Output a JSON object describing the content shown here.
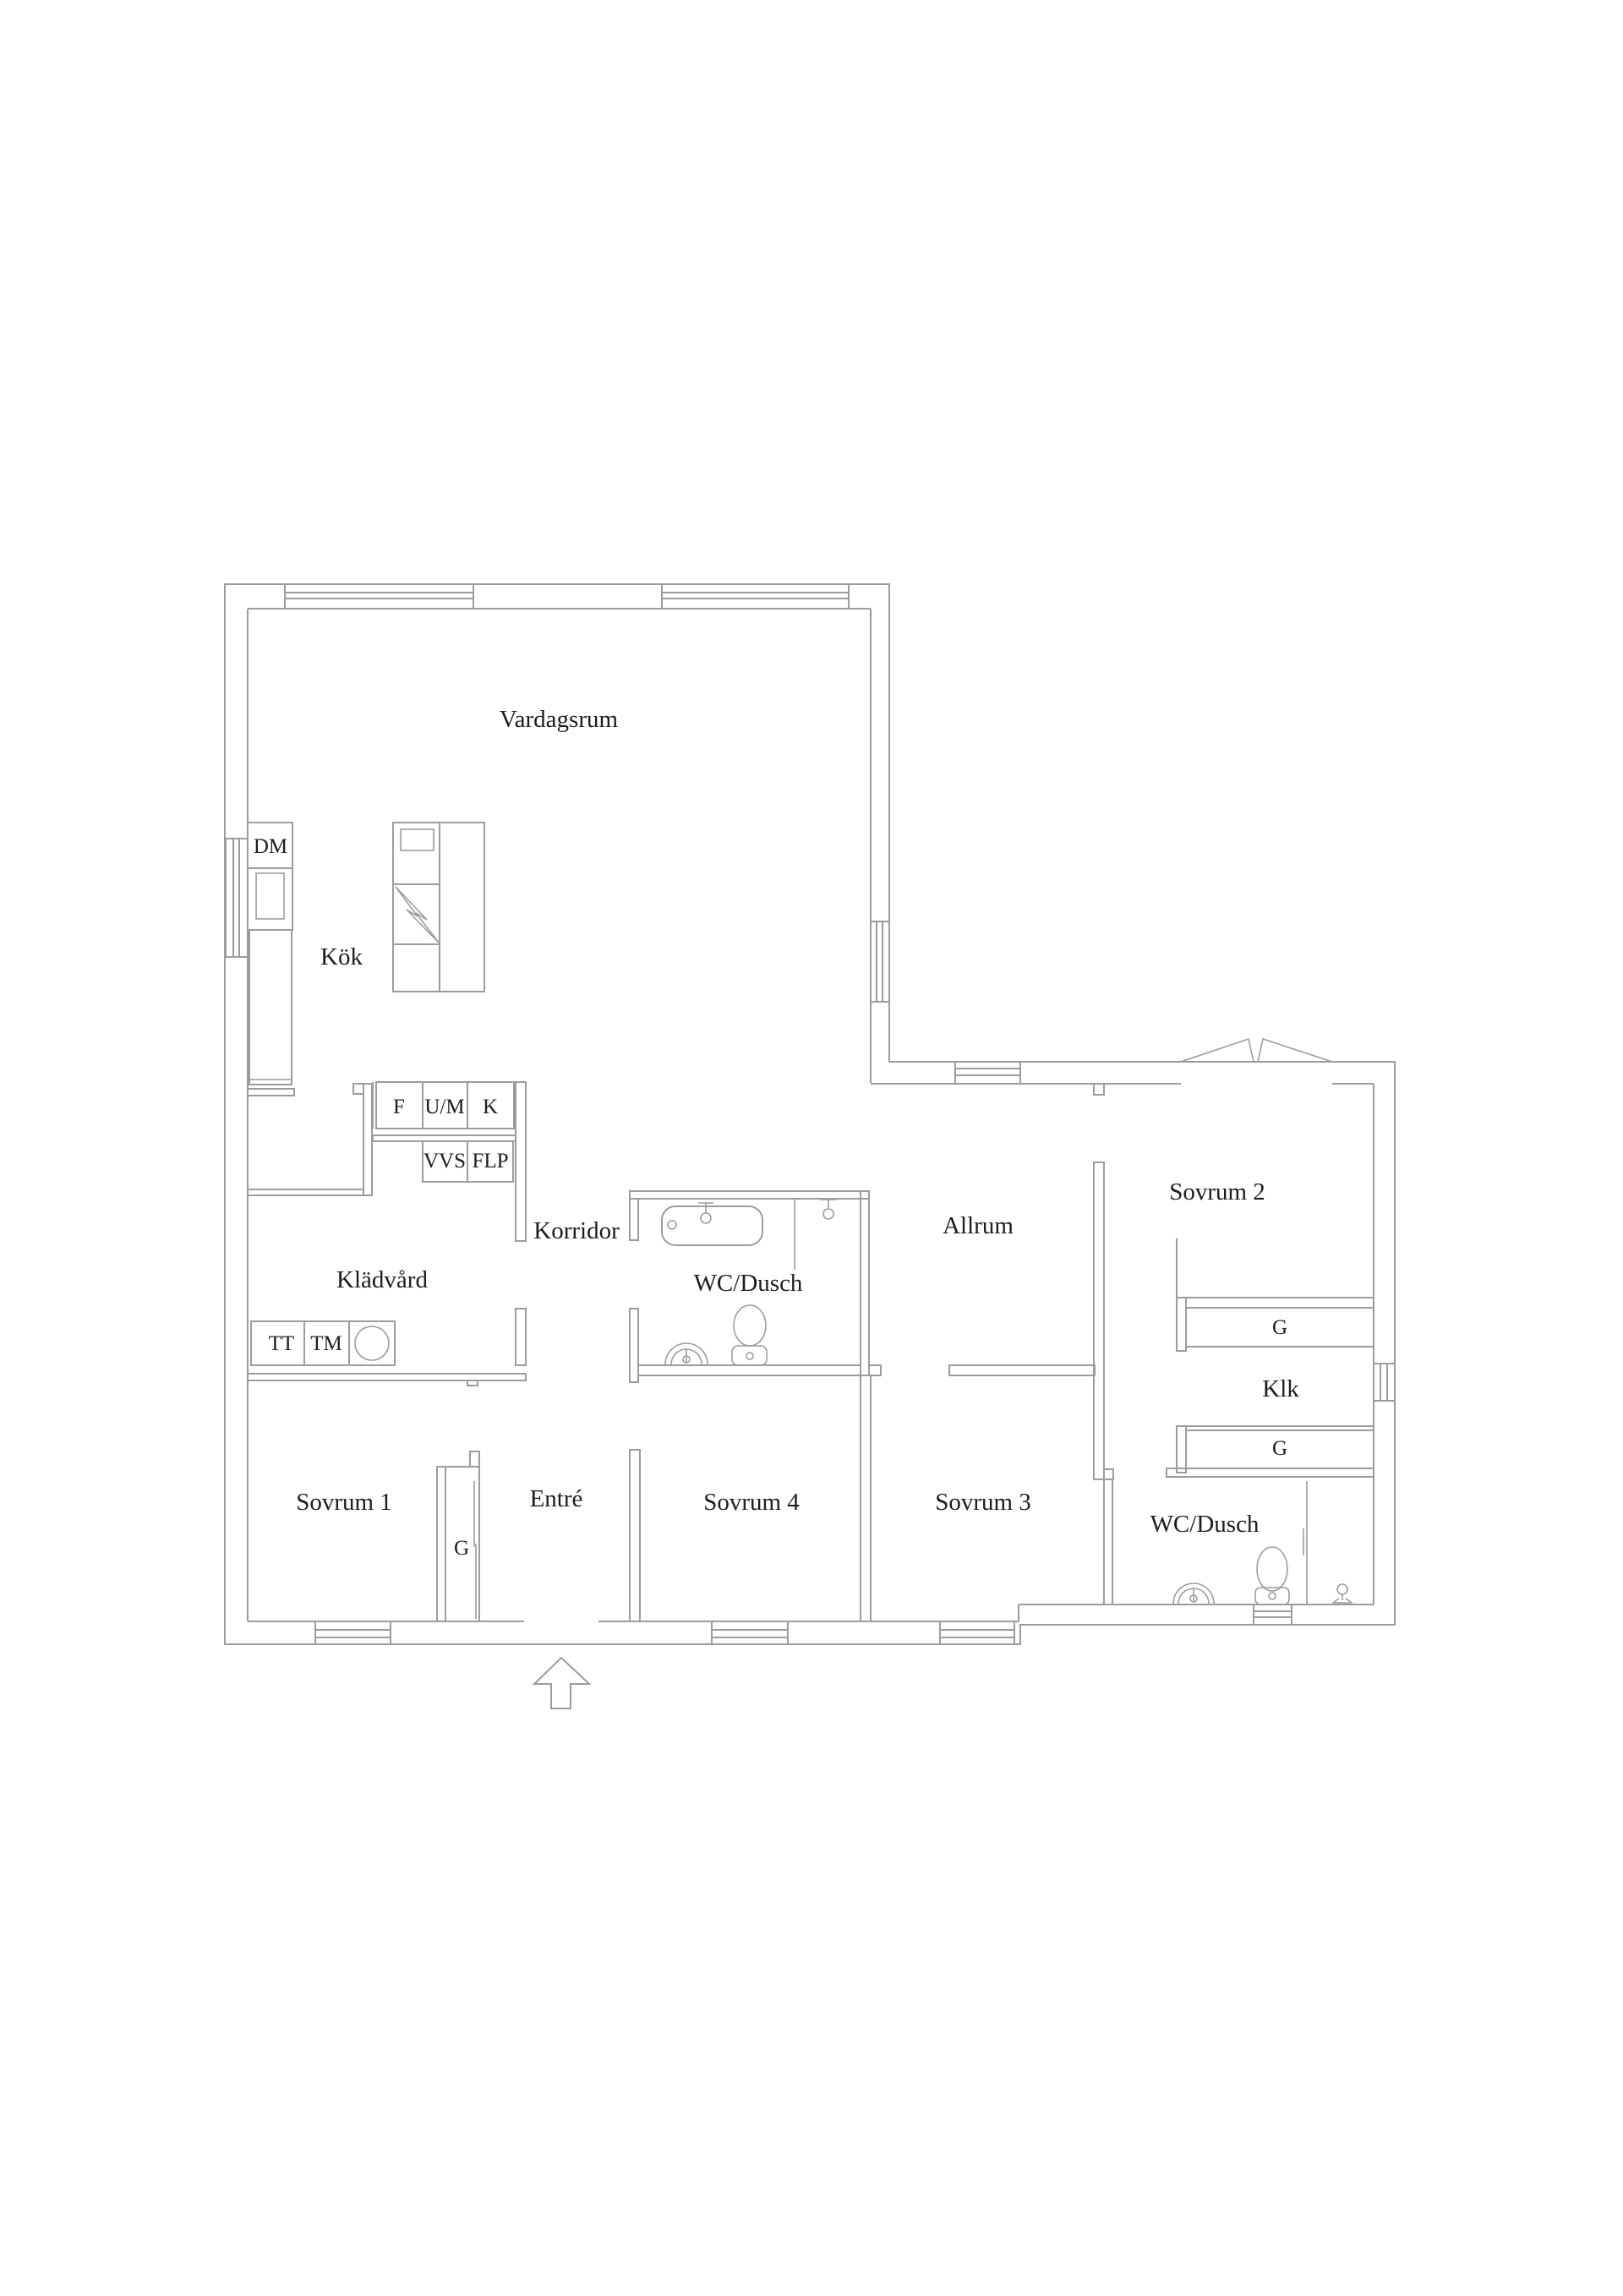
{
  "colors": {
    "background": "#ffffff",
    "line": "#9c9c9c",
    "text": "#1d1d1d"
  },
  "labels": {
    "vardagsrum": "Vardagsrum",
    "kok": "Kök",
    "dm": "DM",
    "f": "F",
    "um": "U/M",
    "k": "K",
    "vvs": "VVS",
    "flp": "FLP",
    "korridor": "Korridor",
    "kladvard": "Klädvård",
    "tt": "TT",
    "tm": "TM",
    "wc_dusch_mid": "WC/Dusch",
    "allrum": "Allrum",
    "sovrum2": "Sovrum 2",
    "g_sovrum2": "G",
    "klk": "Klk",
    "g_klk": "G",
    "sovrum1": "Sovrum 1",
    "entre": "Entré",
    "g_entre": "G",
    "sovrum4": "Sovrum 4",
    "sovrum3": "Sovrum 3",
    "wc_dusch_right": "WC/Dusch"
  },
  "symbols": [
    "bathtub",
    "toilet",
    "round-sink",
    "shower-head-faucet",
    "shower-screen",
    "floor-drain",
    "stove-lightning",
    "kitchen-island",
    "dishwasher",
    "fridge",
    "washer-counter",
    "entrance-arrow",
    "french-doors",
    "sliding-door",
    "window"
  ]
}
